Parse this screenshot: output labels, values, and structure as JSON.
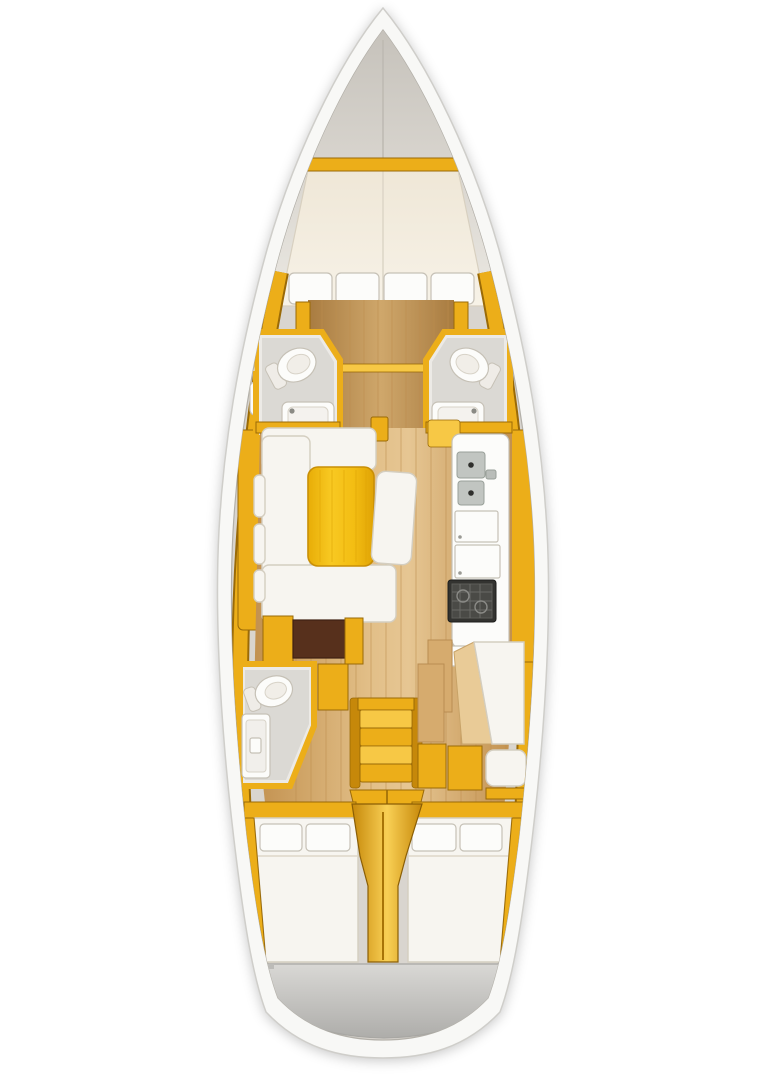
{
  "meta": {
    "description": "Top-down interior layout plan of a sailing yacht (no visible text in image)",
    "visible_text": "none",
    "orientation": "bow at top, stern at bottom"
  },
  "palette": {
    "hull_white": "#f8f8f6",
    "hull_line": "#cfceca",
    "hull_shadow": "#b3b0a9",
    "locker_gray": "#d9d5cf",
    "gold": "#ecae19",
    "gold_light": "#f7c845",
    "gold_dark": "#c6880a",
    "gold_edge": "#9a6a07",
    "wood": "#d6ab6e",
    "wood_dark": "#bd8d4f",
    "wood_light": "#e9cb97",
    "mattress": "#f3ecdf",
    "white_soft": "#f7f5f0",
    "soft_shadow": "#d4cec0",
    "bath_floor": "#dbd9d4",
    "bath_wall": "#eceae6",
    "fixture_white": "#fcfcfa",
    "stove_dark": "#333330",
    "steel": "#c1c5c1",
    "brown_cabinet": "#57301c",
    "transom_gray": "#c9c8c5"
  },
  "plan": {
    "rooms": [
      {
        "name": "anchor-locker",
        "zone": "bow tip"
      },
      {
        "name": "forward-v-berth",
        "fixtures": [
          "double mattress",
          "4 pillows"
        ]
      },
      {
        "name": "forward-head-port",
        "fixtures": [
          "toilet",
          "sink"
        ]
      },
      {
        "name": "forward-head-starboard",
        "fixtures": [
          "toilet",
          "sink"
        ]
      },
      {
        "name": "saloon",
        "fixtures": [
          "u-shaped sofa",
          "gold table",
          "chaise bench",
          "brown cabinet"
        ]
      },
      {
        "name": "galley",
        "fixtures": [
          "double sink",
          "two lockers",
          "stove"
        ]
      },
      {
        "name": "day-head-port",
        "fixtures": [
          "toilet",
          "shower tray"
        ]
      },
      {
        "name": "companionway",
        "fixtures": [
          "stairs",
          "engine hatch"
        ]
      },
      {
        "name": "nav-station",
        "fixtures": [
          "chart table",
          "seat"
        ]
      },
      {
        "name": "aft-cabin-port",
        "fixtures": [
          "double berth",
          "2 pillows"
        ]
      },
      {
        "name": "aft-cabin-starboard",
        "fixtures": [
          "double berth",
          "2 pillows"
        ]
      },
      {
        "name": "transom",
        "zone": "stern"
      }
    ]
  }
}
